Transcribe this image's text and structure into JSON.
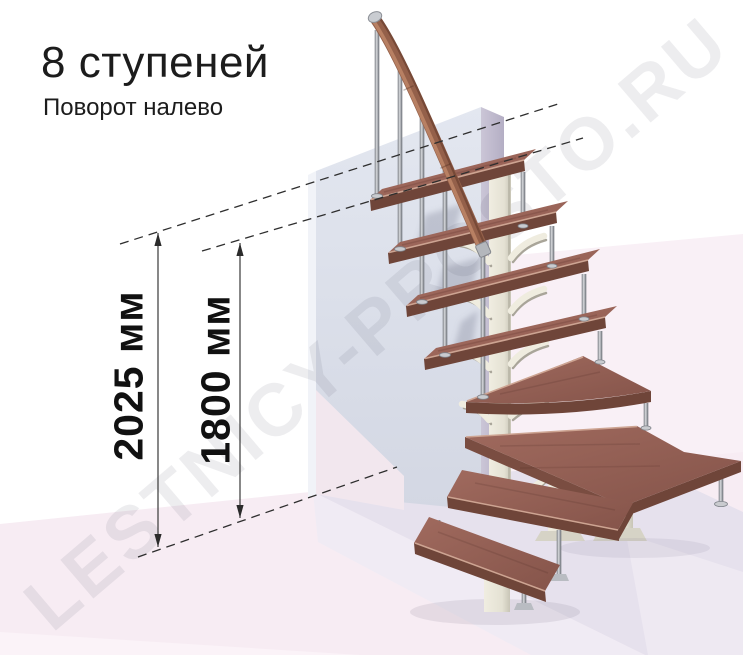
{
  "title": "8 ступеней",
  "subtitle": "Поворот налево",
  "dimensions": {
    "total_height": "2025 мм",
    "secondary_height": "1800 мм"
  },
  "watermark": "LESTNICY-PROSTO.RU",
  "steps_count": "8",
  "turn_direction_note": "Поворот налево",
  "colors": {
    "tread_wood": "#9b675c",
    "tread_wood_dark": "#86544a",
    "tread_front_edge": "#6f4539",
    "tread_rim_highlight": "#cda492",
    "handrail_wood": "#94604a",
    "metal_post": "#a9adb4",
    "support_column": "#e9e6da",
    "wall": "#dce1ec",
    "wall_side": "#c0bacd",
    "floor_platform": "#e6e1ed",
    "floor_pink": "#f7ecf3",
    "background_pink": "#f9f0f6",
    "dimension_line": "#333333",
    "text": "#1c1c1c"
  }
}
